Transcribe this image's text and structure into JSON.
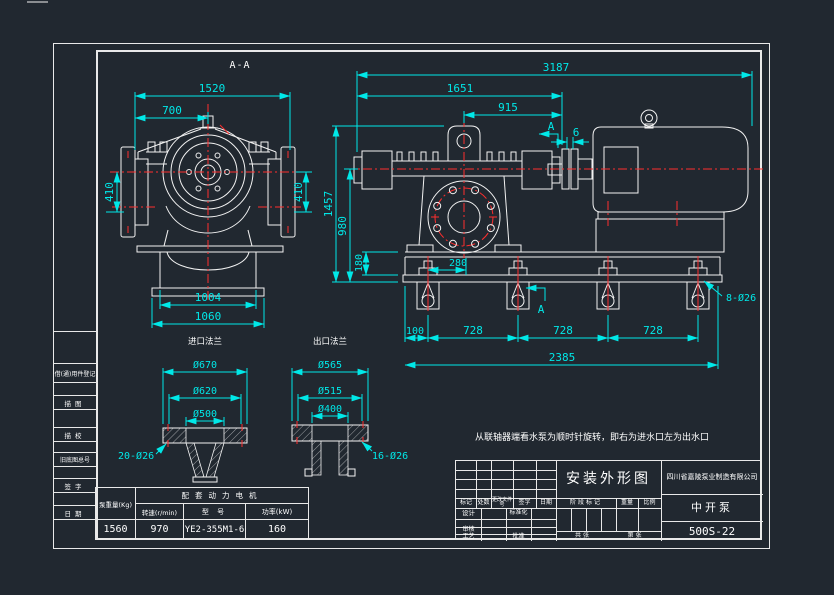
{
  "colors": {
    "background": "#212830",
    "line": "#ffffff",
    "dimension": "#00e8e8",
    "centerline": "#ff2e2e"
  },
  "drawing": {
    "section_view": {
      "title": "A-A",
      "dim_1520": "1520",
      "dim_700": "700",
      "dim_410_left": "410",
      "dim_410_right": "410",
      "dim_1004": "1004",
      "dim_1060": "1060"
    },
    "front_view": {
      "dim_3187": "3187",
      "dim_1651": "1651",
      "dim_915": "915",
      "dim_6": "6",
      "dim_1457": "1457",
      "dim_980": "980",
      "dim_180": "180",
      "dim_280": "280",
      "dim_100": "100",
      "dim_728_1": "728",
      "dim_728_2": "728",
      "dim_728_3": "728",
      "dim_2385": "2385",
      "anchor_holes_label": "8-Ø26",
      "section_mark_top": "A",
      "section_mark_bottom": "A"
    },
    "inlet_flange_detail": {
      "title": "进口法兰",
      "dim_outer": "Ø670",
      "dim_bolt_circle": "Ø620",
      "dim_bore": "Ø500",
      "holes_label": "20-Ø26"
    },
    "outlet_flange_detail": {
      "title": "出口法兰",
      "dim_outer": "Ø565",
      "dim_bolt_circle": "Ø515",
      "dim_bore": "Ø400",
      "holes_label": "16-Ø26"
    },
    "note": "从联轴器端看水泵为顺时针旋转，即右为进水口左为出水口"
  },
  "spec_table": {
    "motor_group_header": "配套动力电机",
    "col_weight": "泵重量(Kg)",
    "col_speed": "转速(r/min)",
    "col_model": "型  号",
    "col_power": "功率(kW)",
    "val_weight": "1560",
    "val_speed": "970",
    "val_model": "YE2-355M1-6",
    "val_power": "160"
  },
  "title_block": {
    "drawing_title": "安装外形图",
    "company": "四川省嘉陵泵业制造有限公司",
    "product_name": "中开泵",
    "drawing_number": "500S-22",
    "rev_mark": "标记",
    "rev_count": "处数",
    "rev_doc": "更改文件号",
    "rev_sign": "签字",
    "rev_date": "日期",
    "design": "设计",
    "standardization": "标准化",
    "review": "审核",
    "process": "工艺",
    "approve": "批准",
    "stage_mark": "阶段标记",
    "weight": "重量",
    "scale": "比例",
    "sheet_total": "共  张",
    "sheet_no": "第  张"
  },
  "margin_strip": {
    "item_1": "借(通)用件登记",
    "item_2": "描图",
    "item_3": "描校",
    "item_4": "旧底图总号",
    "item_5": "签字",
    "item_6": "日期"
  }
}
